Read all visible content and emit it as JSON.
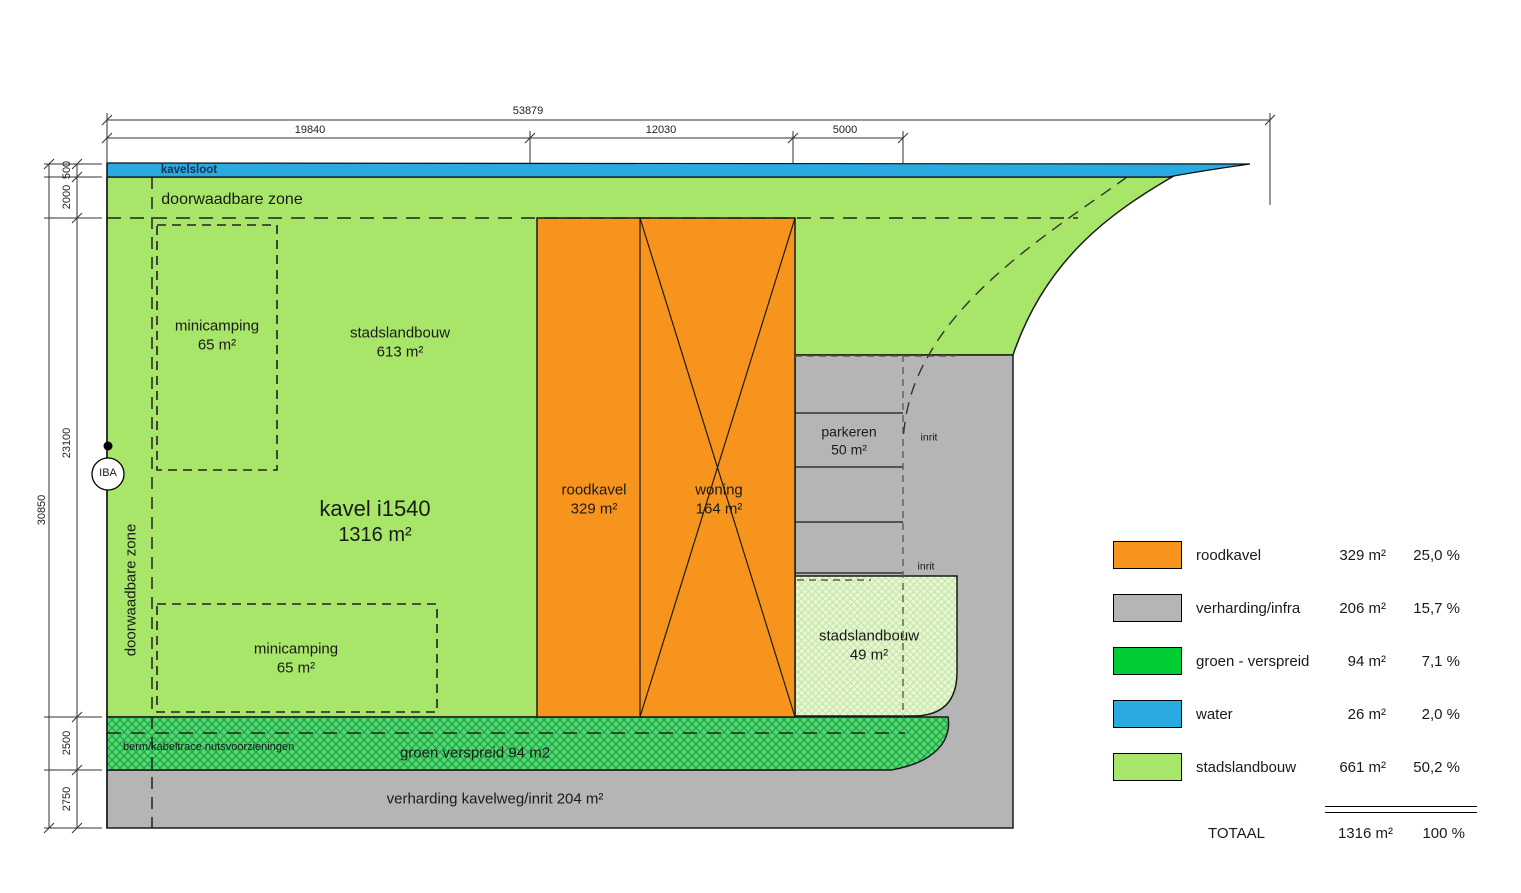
{
  "plan": {
    "kavelsloot": "kavelsloot",
    "doorwaadbare_zone": "doorwaadbare zone",
    "doorwaadbare_zone_vertical": "doorwaadbare zone",
    "minicamping_top": {
      "name": "minicamping",
      "area": "65 m²"
    },
    "minicamping_bottom": {
      "name": "minicamping",
      "area": "65 m²"
    },
    "stadslandbouw_main": {
      "name": "stadslandbouw",
      "area": "613 m²"
    },
    "kavel": {
      "name": "kavel i1540",
      "area": "1316 m²"
    },
    "roodkavel": {
      "name": "roodkavel",
      "area": "329 m²"
    },
    "woning": {
      "name": "woning",
      "area": "164 m²"
    },
    "parkeren": {
      "name": "parkeren",
      "area": "50 m²"
    },
    "inrit_top": "inrit",
    "inrit_bottom": "inrit",
    "stadslandbouw_small": {
      "name": "stadslandbouw",
      "area": "49 m²"
    },
    "berm": "berm/kabeltrace nutsvoorzieningen",
    "groen_verspreid": "groen verspreid 94 m2",
    "verharding": "verharding kavelweg/inrit 204 m²",
    "iba": "IBA"
  },
  "dimensions": {
    "top_total": "53879",
    "top_segments": [
      "19840",
      "12030",
      "5000"
    ],
    "left_total": "30850",
    "left_segments": [
      "500",
      "2000",
      "23100",
      "2500",
      "2750"
    ]
  },
  "colors": {
    "water": "#29abe2",
    "stadslandbouw": "#a7e669",
    "roodkavel": "#f7941e",
    "verharding": "#b5b5b5",
    "groen_verspreid": "#00cc33"
  },
  "legend": {
    "rows": [
      {
        "label": "roodkavel",
        "color": "#f7941e",
        "area": "329 m²",
        "pct": "25,0 %"
      },
      {
        "label": "verharding/infra",
        "color": "#b5b5b5",
        "area": "206 m²",
        "pct": "15,7 %"
      },
      {
        "label": "groen - verspreid",
        "color": "#00cc33",
        "area": "94 m²",
        "pct": "7,1 %"
      },
      {
        "label": "water",
        "color": "#29abe2",
        "area": "26 m²",
        "pct": "2,0 %"
      },
      {
        "label": "stadslandbouw",
        "color": "#a7e669",
        "area": "661 m²",
        "pct": "50,2 %"
      }
    ],
    "total": {
      "label": "TOTAAL",
      "area": "1316 m²",
      "pct": "100 %"
    }
  }
}
